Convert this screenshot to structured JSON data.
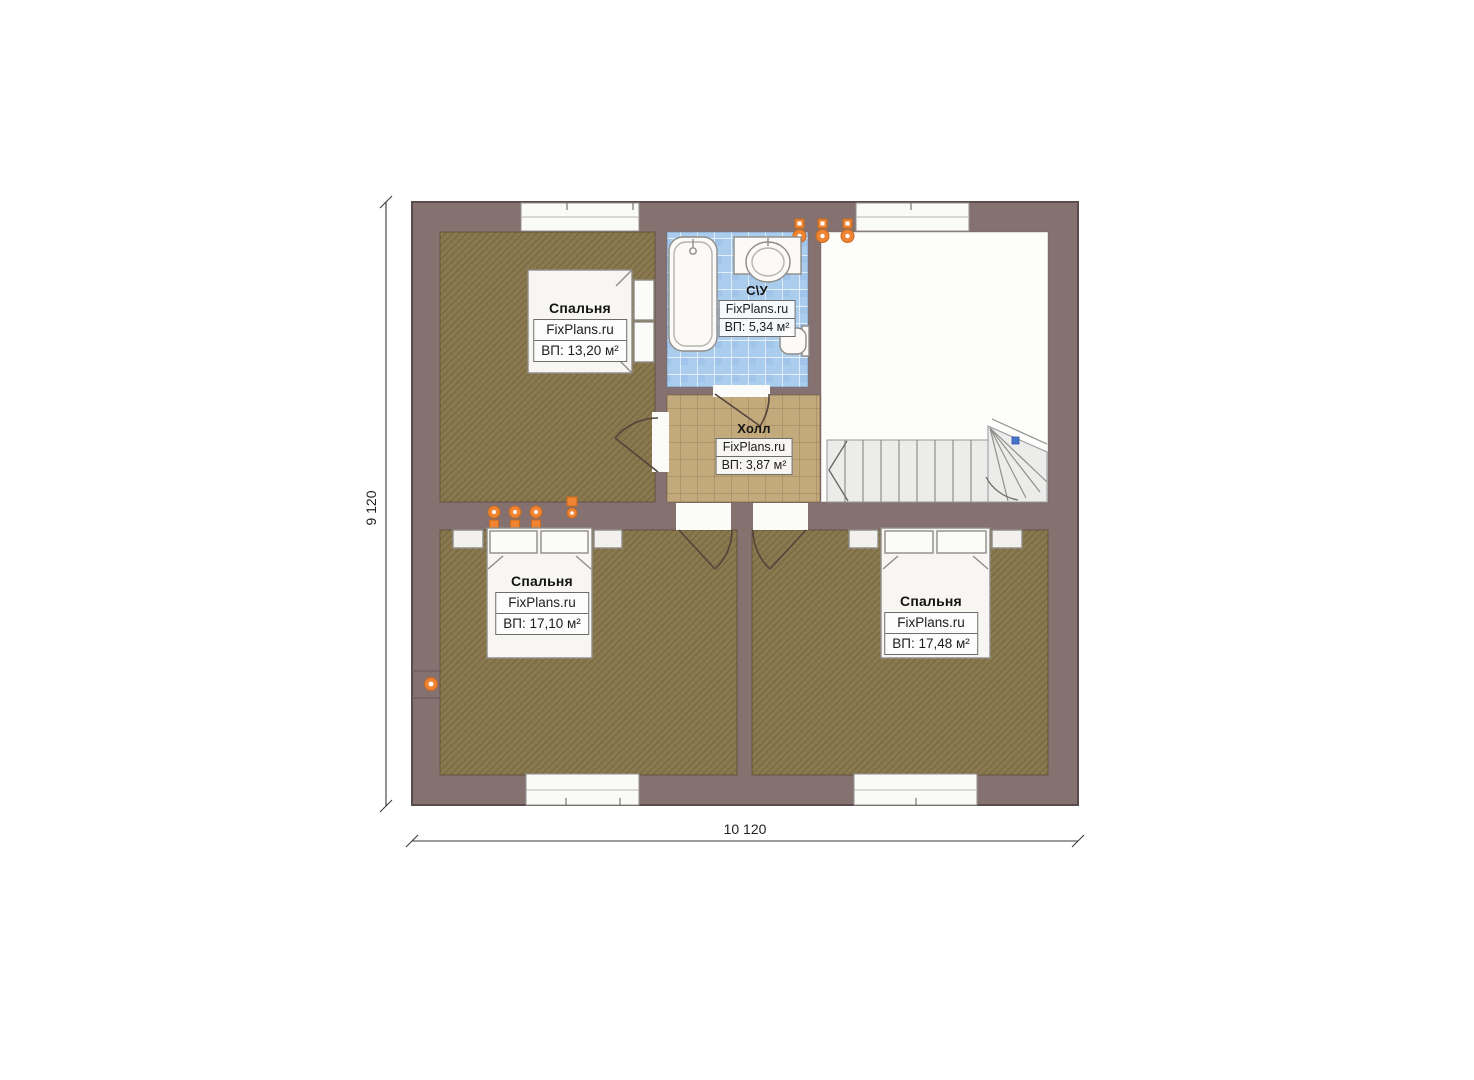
{
  "plan": {
    "rooms": [
      {
        "key": "bedroom-top-left",
        "name": "Спальня",
        "brand": "FixPlans.ru",
        "area": "ВП: 13,20 м²"
      },
      {
        "key": "bathroom",
        "name": "С\\У",
        "brand": "FixPlans.ru",
        "area": "ВП: 5,34 м²"
      },
      {
        "key": "hall",
        "name": "Холл",
        "brand": "FixPlans.ru",
        "area": "ВП: 3,87 м²"
      },
      {
        "key": "bedroom-bottom-left",
        "name": "Спальня",
        "brand": "FixPlans.ru",
        "area": "ВП: 17,10 м²"
      },
      {
        "key": "bedroom-bottom-right",
        "name": "Спальня",
        "brand": "FixPlans.ru",
        "area": "ВП: 17,48 м²"
      }
    ],
    "dimensions": {
      "width_label": "10 120",
      "height_label": "9 120"
    },
    "colors": {
      "wall": "#847170",
      "wall_edge": "#5a4c4a",
      "bedroom_floor": "#8b7950",
      "hall_floor": "#c3aa7d",
      "bath_floor": "#aacdee",
      "empty_room": "#fdfdfc",
      "accent_orange": "#ef8433",
      "stair_marker_blue": "#4a74c9"
    }
  }
}
